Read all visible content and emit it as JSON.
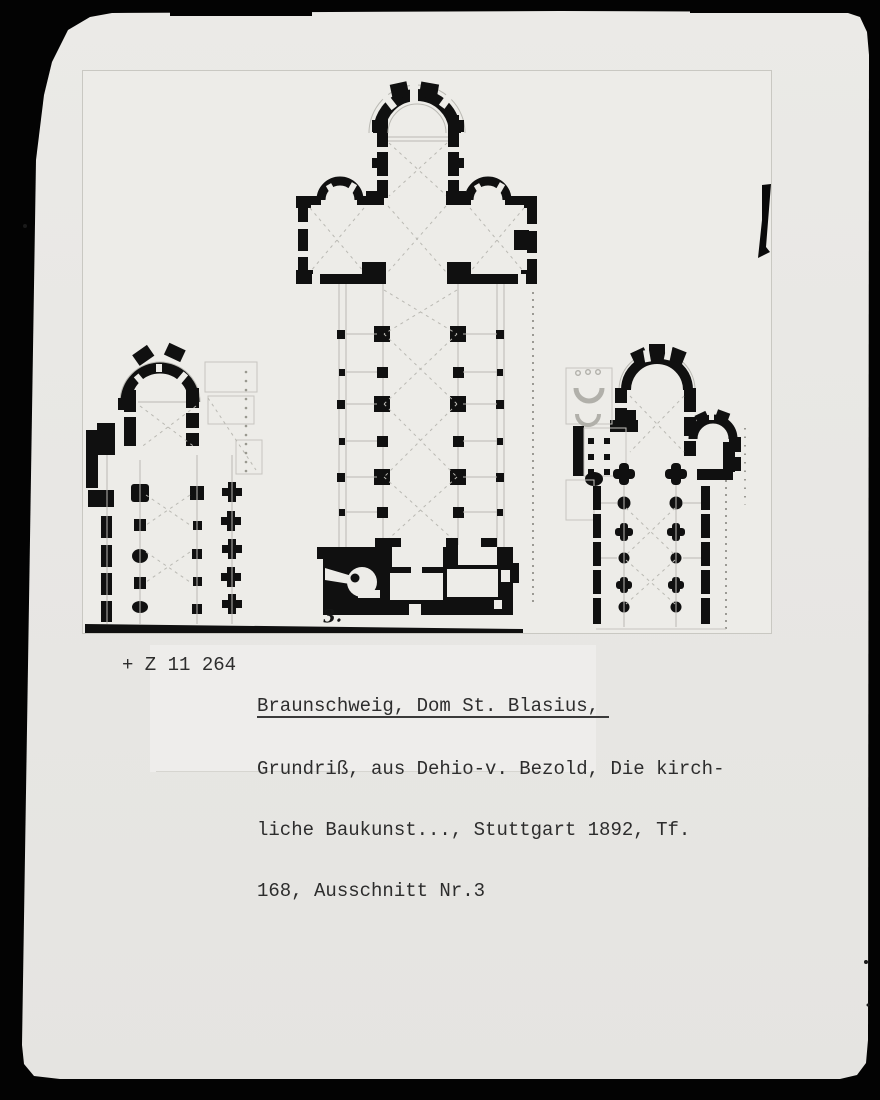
{
  "colors": {
    "frame": "#030303",
    "photo": "#e8e7e4",
    "plate": "#edece8",
    "ink": "#101010",
    "faint": "#bab9b3",
    "captionink": "#2d2d2d"
  },
  "caption": {
    "catalog_number": "+ Z 11 264",
    "title": "Braunschweig, Dom St. Blasius,",
    "line2": "Grundriß, aus Dehio-v. Bezold, Die kirch-",
    "line3": "liche Baukunst..., Stuttgart 1892, Tf.",
    "line4": "168, Ausschnitt Nr.3"
  },
  "figure": {
    "plate_number": "3."
  }
}
